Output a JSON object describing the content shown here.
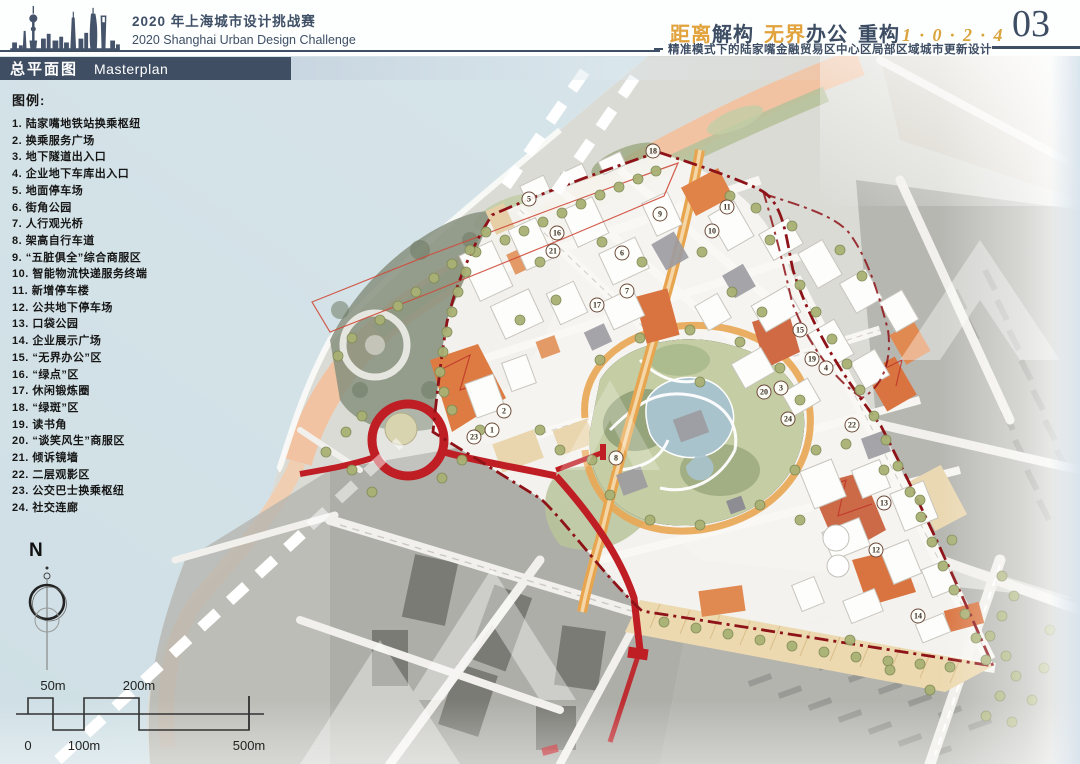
{
  "header": {
    "event_title_cn": "2020 年上海城市设计挑战赛",
    "event_title_en": "2020 Shanghai Urban Design Challenge",
    "theme_segments": {
      "t1": "距离",
      "t2": "解构",
      "t3": "无界",
      "t4": "办公",
      "t5": "重构",
      "code": "1 · 0 · 2 · 4"
    },
    "subtitle": "精准模式下的陆家嘴金融贸易区中心区局部区域城市更新设计",
    "page_number": "03"
  },
  "section_banner": {
    "title_cn": "总平面图",
    "title_en": "Masterplan"
  },
  "legend": {
    "title": "图例:",
    "items": [
      {
        "num": "1",
        "label": "陆家嘴地铁站换乘枢纽"
      },
      {
        "num": "2",
        "label": "换乘服务广场"
      },
      {
        "num": "3",
        "label": "地下隧道出入口"
      },
      {
        "num": "4",
        "label": "企业地下车库出入口"
      },
      {
        "num": "5",
        "label": "地面停车场"
      },
      {
        "num": "6",
        "label": "街角公园"
      },
      {
        "num": "7",
        "label": "人行观光桥"
      },
      {
        "num": "8",
        "label": "架高自行车道"
      },
      {
        "num": "9",
        "label": "“五脏俱全”综合商服区"
      },
      {
        "num": "10",
        "label": "智能物流快递服务终端"
      },
      {
        "num": "11",
        "label": "新增停车楼"
      },
      {
        "num": "12",
        "label": "公共地下停车场"
      },
      {
        "num": "13",
        "label": "口袋公园"
      },
      {
        "num": "14",
        "label": "企业展示广场"
      },
      {
        "num": "15",
        "label": "“无界办公”区"
      },
      {
        "num": "16",
        "label": "“绿点”区"
      },
      {
        "num": "17",
        "label": "休闲锻炼圈"
      },
      {
        "num": "18",
        "label": "“绿斑”区"
      },
      {
        "num": "19",
        "label": "读书角"
      },
      {
        "num": "20",
        "label": "“谈笑风生”商服区"
      },
      {
        "num": "21",
        "label": "倾诉镜墙"
      },
      {
        "num": "22",
        "label": "二层观影区"
      },
      {
        "num": "23",
        "label": "公交巴士换乘枢纽"
      },
      {
        "num": "24",
        "label": "社交连廊"
      }
    ]
  },
  "compass": {
    "label": "N"
  },
  "scale_bar": {
    "top_labels": [
      "50m",
      "200m"
    ],
    "bottom_labels": [
      "0",
      "100m",
      "500m"
    ]
  },
  "map": {
    "markers": [
      {
        "n": "1",
        "x": 492,
        "y": 430
      },
      {
        "n": "2",
        "x": 504,
        "y": 411
      },
      {
        "n": "3",
        "x": 781,
        "y": 388
      },
      {
        "n": "4",
        "x": 826,
        "y": 368
      },
      {
        "n": "5",
        "x": 529,
        "y": 199
      },
      {
        "n": "6",
        "x": 622,
        "y": 253
      },
      {
        "n": "7",
        "x": 627,
        "y": 291
      },
      {
        "n": "8",
        "x": 616,
        "y": 458
      },
      {
        "n": "9",
        "x": 660,
        "y": 214
      },
      {
        "n": "10",
        "x": 712,
        "y": 231
      },
      {
        "n": "11",
        "x": 727,
        "y": 207
      },
      {
        "n": "12",
        "x": 876,
        "y": 550
      },
      {
        "n": "13",
        "x": 884,
        "y": 503
      },
      {
        "n": "14",
        "x": 918,
        "y": 616
      },
      {
        "n": "15",
        "x": 800,
        "y": 330
      },
      {
        "n": "16",
        "x": 557,
        "y": 233
      },
      {
        "n": "17",
        "x": 597,
        "y": 305
      },
      {
        "n": "18",
        "x": 653,
        "y": 151
      },
      {
        "n": "19",
        "x": 812,
        "y": 359
      },
      {
        "n": "20",
        "x": 764,
        "y": 392
      },
      {
        "n": "21",
        "x": 553,
        "y": 251
      },
      {
        "n": "22",
        "x": 852,
        "y": 425
      },
      {
        "n": "23",
        "x": 474,
        "y": 437
      },
      {
        "n": "24",
        "x": 788,
        "y": 419
      }
    ]
  },
  "colors": {
    "navy": "#3f4e63",
    "gold": "#e2a33c",
    "route_red": "#bf1e24",
    "boundary_red": "#8e1318",
    "waterfront_peach": "#f2c29f",
    "tree_green": "#a9b174",
    "lake_blue": "#a9c3cd",
    "water_blue": "#cfdfe4",
    "context_gray": "#a8a8a4"
  }
}
